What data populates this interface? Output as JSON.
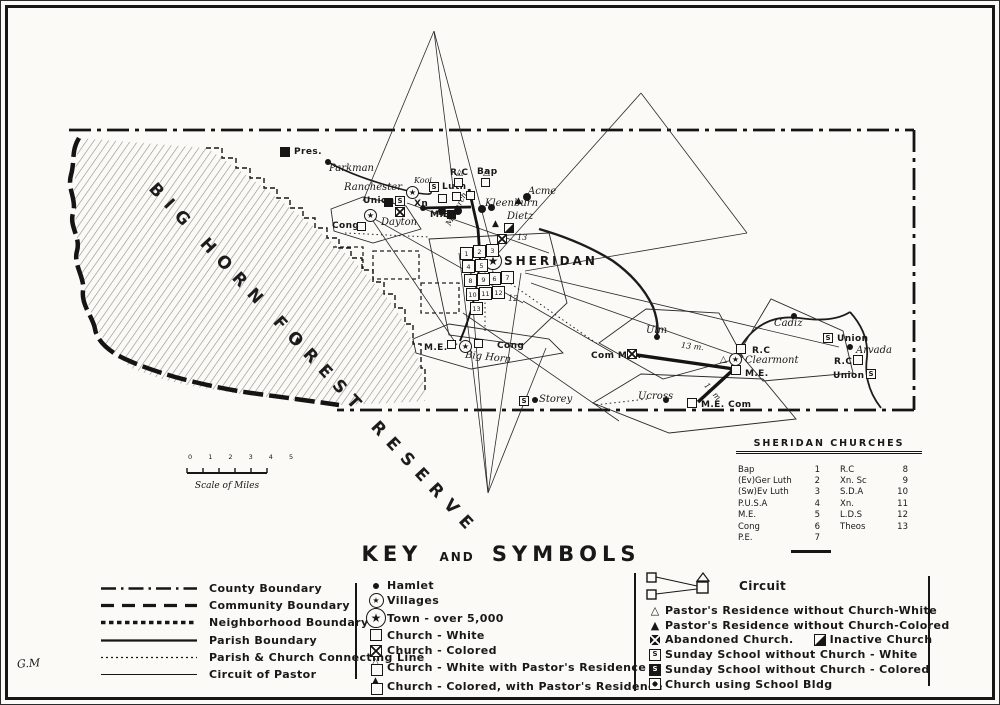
{
  "icons": {
    "star": "★",
    "s": "S",
    "tri_open": "△",
    "tri_filled": "▲"
  },
  "map": {
    "forest_label": "BIG HORN FOREST RESERVE",
    "signature": "G.M",
    "scale_ticks": "0 1 2 3 4 5",
    "scale_label": "Scale of Miles",
    "places": {
      "pres": "Pres.",
      "parkman": "Parkman",
      "ranchester": "Ranchester",
      "union_nw": "Union",
      "kooi": "Kooi",
      "cong_dayton": "Cong",
      "dayton": "Dayton",
      "xn": "Xn",
      "rc_top": "R.C",
      "bap_top": "Bap",
      "luth": "Luth",
      "acme": "Acme",
      "kleenburn": "Kleenburn",
      "dietz": "Dietz",
      "me_north": "M.E.",
      "monarch": "Monarch",
      "sheridan": "SHERIDAN",
      "n13": "13",
      "mi12": "12",
      "me_bighorn": "M.E.",
      "cong_bighorn": "Cong",
      "bighorn": "Big Horn",
      "storey": "Storey",
      "ulm": "Ulm",
      "com_me": "Com M.E.",
      "mi13": "13 m.",
      "rc_clearmont": "R.C",
      "clearmont": "Clearmont",
      "me_clearmont": "M.E.",
      "mi11": "11 m.",
      "ucross": "Ucross",
      "me_com": "M.E. Com",
      "cadiz": "Cadiz",
      "union_arvada_n": "Union",
      "arvada": "Arvada",
      "rc_arvada": "R.C",
      "union_arvada_s": "Union"
    },
    "sheridan_numbers": [
      "1",
      "2",
      "3",
      "4",
      "5",
      "6",
      "7",
      "8",
      "9",
      "10",
      "11",
      "12",
      "13"
    ]
  },
  "churches_table": {
    "title": "SHERIDAN CHURCHES",
    "rows_left": [
      {
        "name": "Bap",
        "num": "1"
      },
      {
        "name": "(Ev)Ger Luth",
        "num": "2"
      },
      {
        "name": "(Sw)Ev Luth",
        "num": "3"
      },
      {
        "name": "P.U.S.A",
        "num": "4"
      },
      {
        "name": "M.E.",
        "num": "5"
      },
      {
        "name": "Cong",
        "num": "6"
      },
      {
        "name": "P.E.",
        "num": "7"
      }
    ],
    "rows_right": [
      {
        "name": "R.C",
        "num": "8"
      },
      {
        "name": "Xn. Sc",
        "num": "9"
      },
      {
        "name": "S.D.A",
        "num": "10"
      },
      {
        "name": "Xn.",
        "num": "11"
      },
      {
        "name": "L.D.S",
        "num": "12"
      },
      {
        "name": "Theos",
        "num": "13"
      }
    ]
  },
  "key": {
    "title": {
      "key": "KEY",
      "and": "AND",
      "symbols": "SYMBOLS"
    },
    "boundaries": [
      "County Boundary",
      "Community Boundary",
      "Neighborhood Boundary",
      "Parish Boundary",
      "Parish & Church Connecting Line",
      "Circuit of Pastor"
    ],
    "places": [
      "Hamlet",
      "Villages",
      "Town - over 5,000",
      "Church - White",
      "Church - Colored",
      "Church - White with Pastor's Residence",
      "Church - Colored, with Pastor's Residence"
    ],
    "right": {
      "circuit": "Circuit",
      "items": [
        "Pastor's Residence without Church-White",
        "Pastor's Residence without Church-Colored",
        "Abandoned Church.",
        "Inactive Church",
        "Sunday School without Church - White",
        "Sunday School without Church - Colored",
        "Church using School Bldg"
      ]
    }
  }
}
